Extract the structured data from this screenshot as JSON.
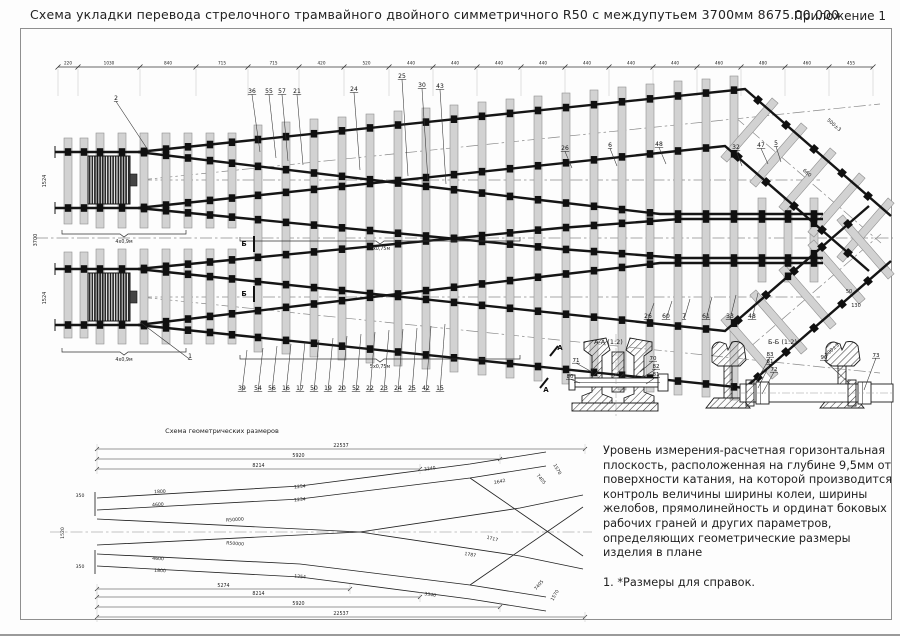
{
  "page": {
    "title": "Схема укладки перевода стрелочного трамвайного двойного симметричного R50 с междупутьем 3700мм  8675.00.000",
    "annex": "Приложение 1"
  },
  "main": {
    "dim_chain": {
      "y": 67,
      "ticks": [
        58,
        78,
        140,
        196,
        248,
        299,
        344,
        389,
        433,
        477,
        521,
        565,
        609,
        653,
        697,
        741,
        785,
        829,
        873
      ],
      "labels": [
        "220",
        "1030",
        "840",
        "715",
        "715",
        "420",
        "520",
        "440",
        "440",
        "440",
        "440",
        "440",
        "440",
        "440",
        "460",
        "480",
        "460",
        "455"
      ]
    },
    "centerlines": [
      "36,238 893,238",
      "140,180 820,180",
      "140,297 820,297",
      "140,180 880,104",
      "140,297 880,373",
      "735,117 881,243",
      "735,360 881,234"
    ],
    "sleepers": [
      [
        68,
        138,
        224
      ],
      [
        68,
        252,
        338
      ],
      [
        84,
        138,
        224
      ],
      [
        84,
        252,
        338
      ],
      [
        100,
        133,
        228
      ],
      [
        100,
        249,
        344
      ],
      [
        122,
        133,
        228
      ],
      [
        122,
        249,
        344
      ],
      [
        144,
        133,
        228
      ],
      [
        144,
        249,
        344
      ],
      [
        166,
        133,
        228
      ],
      [
        166,
        249,
        344
      ],
      [
        188,
        133,
        228
      ],
      [
        188,
        249,
        344
      ],
      [
        210,
        133,
        228
      ],
      [
        210,
        249,
        344
      ],
      [
        232,
        133,
        228
      ],
      [
        232,
        249,
        344
      ],
      [
        258,
        125,
        352
      ],
      [
        286,
        122,
        354
      ],
      [
        314,
        119,
        357
      ],
      [
        342,
        117,
        360
      ],
      [
        370,
        114,
        363
      ],
      [
        398,
        111,
        366
      ],
      [
        426,
        108,
        369
      ],
      [
        454,
        105,
        372
      ],
      [
        482,
        102,
        375
      ],
      [
        510,
        99,
        378
      ],
      [
        538,
        96,
        381
      ],
      [
        566,
        93,
        384
      ],
      [
        594,
        90,
        387
      ],
      [
        622,
        87,
        390
      ],
      [
        650,
        84,
        392
      ],
      [
        678,
        81,
        395
      ],
      [
        706,
        79,
        397
      ],
      [
        734,
        76,
        400
      ],
      [
        762,
        198,
        282
      ],
      [
        788,
        198,
        282
      ],
      [
        814,
        198,
        282
      ]
    ],
    "diag_sleepers": [
      [
        749.5,
        130,
        41
      ],
      [
        778.5,
        155,
        41
      ],
      [
        807.5,
        180,
        41
      ],
      [
        836.5,
        205,
        41
      ],
      [
        865.5,
        230,
        41
      ],
      [
        749.5,
        347,
        -41
      ],
      [
        778.5,
        322,
        -41
      ],
      [
        807.5,
        297,
        -41
      ],
      [
        836.5,
        272,
        -41
      ],
      [
        865.5,
        247,
        -41
      ]
    ],
    "rails": [
      "55,152 138,152 745,89 891,216",
      "55,208 138,208 725,146 869,271",
      "138,152 540,200 660,214 823,214",
      "138,208 560,249 680,258 823,258",
      "55,325 138,325 745,388 891,261",
      "55,269 138,269 725,331 869,206",
      "138,325 540,277 660,263 823,263",
      "138,269 560,228 680,219 823,219"
    ],
    "extra_markers": [
      [
        758,
        100,
        41
      ],
      [
        786,
        125,
        41
      ],
      [
        814,
        149,
        41
      ],
      [
        842,
        173,
        41
      ],
      [
        868,
        196,
        41
      ],
      [
        738,
        157,
        41
      ],
      [
        766,
        182,
        41
      ],
      [
        794,
        206,
        41
      ],
      [
        822,
        230,
        41
      ],
      [
        848,
        253,
        41
      ],
      [
        758,
        377,
        -41
      ],
      [
        786,
        352,
        -41
      ],
      [
        814,
        328,
        -41
      ],
      [
        842,
        304,
        -41
      ],
      [
        868,
        281,
        -41
      ],
      [
        738,
        320,
        -41
      ],
      [
        766,
        295,
        -41
      ],
      [
        794,
        271,
        -41
      ],
      [
        822,
        247,
        -41
      ],
      [
        848,
        224,
        -41
      ]
    ],
    "callouts": [
      [
        "2",
        116,
        100,
        150,
        153
      ],
      [
        "36",
        252,
        93,
        260,
        152
      ],
      [
        "55",
        269,
        93,
        276,
        158
      ],
      [
        "57",
        282,
        93,
        288,
        161
      ],
      [
        "21",
        297,
        93,
        303,
        165
      ],
      [
        "24",
        354,
        91,
        360,
        170
      ],
      [
        "25",
        402,
        78,
        408,
        176
      ],
      [
        "30",
        422,
        87,
        428,
        181
      ],
      [
        "43",
        440,
        88,
        446,
        184
      ],
      [
        "26",
        565,
        150,
        572,
        168
      ],
      [
        "6",
        610,
        147,
        617,
        166
      ],
      [
        "48",
        659,
        146,
        666,
        164
      ],
      [
        "32",
        736,
        149,
        742,
        166
      ],
      [
        "47",
        761,
        147,
        768,
        164
      ],
      [
        "5",
        776,
        145,
        781,
        162
      ],
      [
        "39",
        242,
        390,
        247,
        350
      ],
      [
        "54",
        258,
        390,
        263,
        348
      ],
      [
        "56",
        272,
        390,
        277,
        346
      ],
      [
        "16",
        286,
        390,
        291,
        344
      ],
      [
        "17",
        300,
        390,
        305,
        342
      ],
      [
        "50",
        314,
        390,
        319,
        340
      ],
      [
        "19",
        328,
        390,
        333,
        338
      ],
      [
        "20",
        342,
        390,
        347,
        336
      ],
      [
        "52",
        356,
        390,
        361,
        334
      ],
      [
        "22",
        370,
        390,
        375,
        332
      ],
      [
        "23",
        384,
        390,
        389,
        330
      ],
      [
        "24",
        398,
        390,
        403,
        329
      ],
      [
        "25",
        412,
        390,
        417,
        328
      ],
      [
        "42",
        426,
        390,
        431,
        326
      ],
      [
        "15",
        440,
        390,
        445,
        324
      ],
      [
        "26",
        648,
        318,
        654,
        303
      ],
      [
        "60",
        666,
        318,
        672,
        301
      ],
      [
        "7",
        684,
        318,
        690,
        299
      ],
      [
        "61",
        706,
        318,
        712,
        297
      ],
      [
        "33",
        730,
        318,
        736,
        295
      ],
      [
        "48",
        752,
        318,
        758,
        293
      ],
      [
        "1",
        190,
        358,
        140,
        322
      ]
    ],
    "rot_labels": [
      [
        "500±3",
        833,
        126,
        41
      ],
      [
        "500±3",
        833,
        351,
        -41
      ],
      [
        "660",
        806,
        174,
        41
      ],
      [
        "50",
        849,
        293,
        0
      ],
      [
        "130",
        856,
        307,
        0
      ],
      [
        "1524",
        46,
        181,
        -90
      ],
      [
        "1524",
        46,
        298,
        -90
      ],
      [
        "3700",
        37,
        240,
        -90
      ]
    ],
    "braces": [
      [
        62,
        186,
        234,
        "4х0,9м"
      ],
      [
        240,
        520,
        241,
        "5х0,75м"
      ],
      [
        62,
        186,
        352,
        "4х0,9м"
      ],
      [
        240,
        520,
        359,
        "5х0,75м"
      ]
    ],
    "cut_marks": [
      [
        "Б",
        244,
        246,
        "254,236 254,252"
      ],
      [
        "Б",
        244,
        296,
        "254,286 254,302"
      ],
      [
        "А",
        560,
        350,
        "550,356 558,346"
      ],
      [
        "А",
        546,
        392,
        "540,388 548,378"
      ]
    ]
  },
  "scheme": {
    "title": "Схема геометрических размеров",
    "lines": [
      "97,498 300,486 470,464 546,452",
      "97,510 300,499 470,478 546,466",
      "97,519 360,532 520,556 583,569",
      "97,566 300,577 470,599 546,611",
      "97,554 300,564 470,585 546,597",
      "97,545 360,532 520,508 583,495",
      "470,478 583,556",
      "470,585 583,507",
      "95,492 95,516",
      "95,550 95,574"
    ],
    "axis": "50,532 592,532",
    "dims": [
      [
        449,
        97,
        585,
        "22537"
      ],
      [
        459,
        97,
        500,
        "5920"
      ],
      [
        469,
        97,
        420,
        "8214"
      ],
      [
        589,
        97,
        350,
        "5274"
      ],
      [
        597,
        97,
        420,
        "8214"
      ],
      [
        607,
        97,
        500,
        "5920"
      ],
      [
        617,
        97,
        585,
        "22537"
      ]
    ],
    "small_labels": [
      [
        "350",
        80,
        497,
        0
      ],
      [
        "350",
        80,
        568,
        0
      ],
      [
        "1520",
        64,
        533,
        -90
      ],
      [
        "1800",
        160,
        493,
        -3
      ],
      [
        "4600",
        158,
        506,
        -3
      ],
      [
        "1254",
        300,
        488,
        -5
      ],
      [
        "1234",
        300,
        501,
        -5
      ],
      [
        "3340",
        430,
        470,
        -8
      ],
      [
        "2642",
        500,
        483,
        -12
      ],
      [
        "1717",
        492,
        540,
        14
      ],
      [
        "1787",
        470,
        556,
        10
      ],
      [
        "1800",
        160,
        572,
        3
      ],
      [
        "4600",
        158,
        560,
        3
      ],
      [
        "1254",
        300,
        578,
        5
      ],
      [
        "3340",
        430,
        596,
        8
      ],
      [
        "1570",
        556,
        470,
        60
      ],
      [
        "1570",
        556,
        596,
        -60
      ],
      [
        "R50000",
        235,
        521,
        -4
      ],
      [
        "R50000",
        235,
        545,
        4
      ],
      [
        "7405",
        540,
        480,
        50
      ],
      [
        "7405",
        540,
        586,
        -50
      ]
    ]
  },
  "sections": {
    "aa": {
      "label": "А-А (1:2)",
      "callouts": [
        [
          "71",
          576,
          362,
          592,
          372
        ],
        [
          "80",
          570,
          378,
          580,
          383
        ],
        [
          "70",
          653,
          360,
          640,
          372
        ],
        [
          "82",
          656,
          368,
          642,
          378
        ],
        [
          "81",
          656,
          376,
          646,
          384
        ]
      ]
    },
    "bb": {
      "label": "Б-Б (1:2)",
      "callouts": [
        [
          "83",
          770,
          356,
          756,
          382
        ],
        [
          "81",
          770,
          363,
          758,
          388
        ],
        [
          "72",
          774,
          371,
          762,
          394
        ],
        [
          "90",
          824,
          359,
          850,
          384
        ],
        [
          "73",
          876,
          357,
          864,
          390
        ]
      ]
    }
  },
  "notes": {
    "paragraph": "Уровень измерения-расчетная горизонтальная плоскость, расположенная на глубине 9,5мм от поверхности катания, на которой производится контроль величины ширины колеи, ширины желобов, прямолинейность и ординат боковых рабочих граней и других параметров, определяющих геометрические размеры изделия в плане",
    "item1": "1. *Размеры для справок."
  }
}
